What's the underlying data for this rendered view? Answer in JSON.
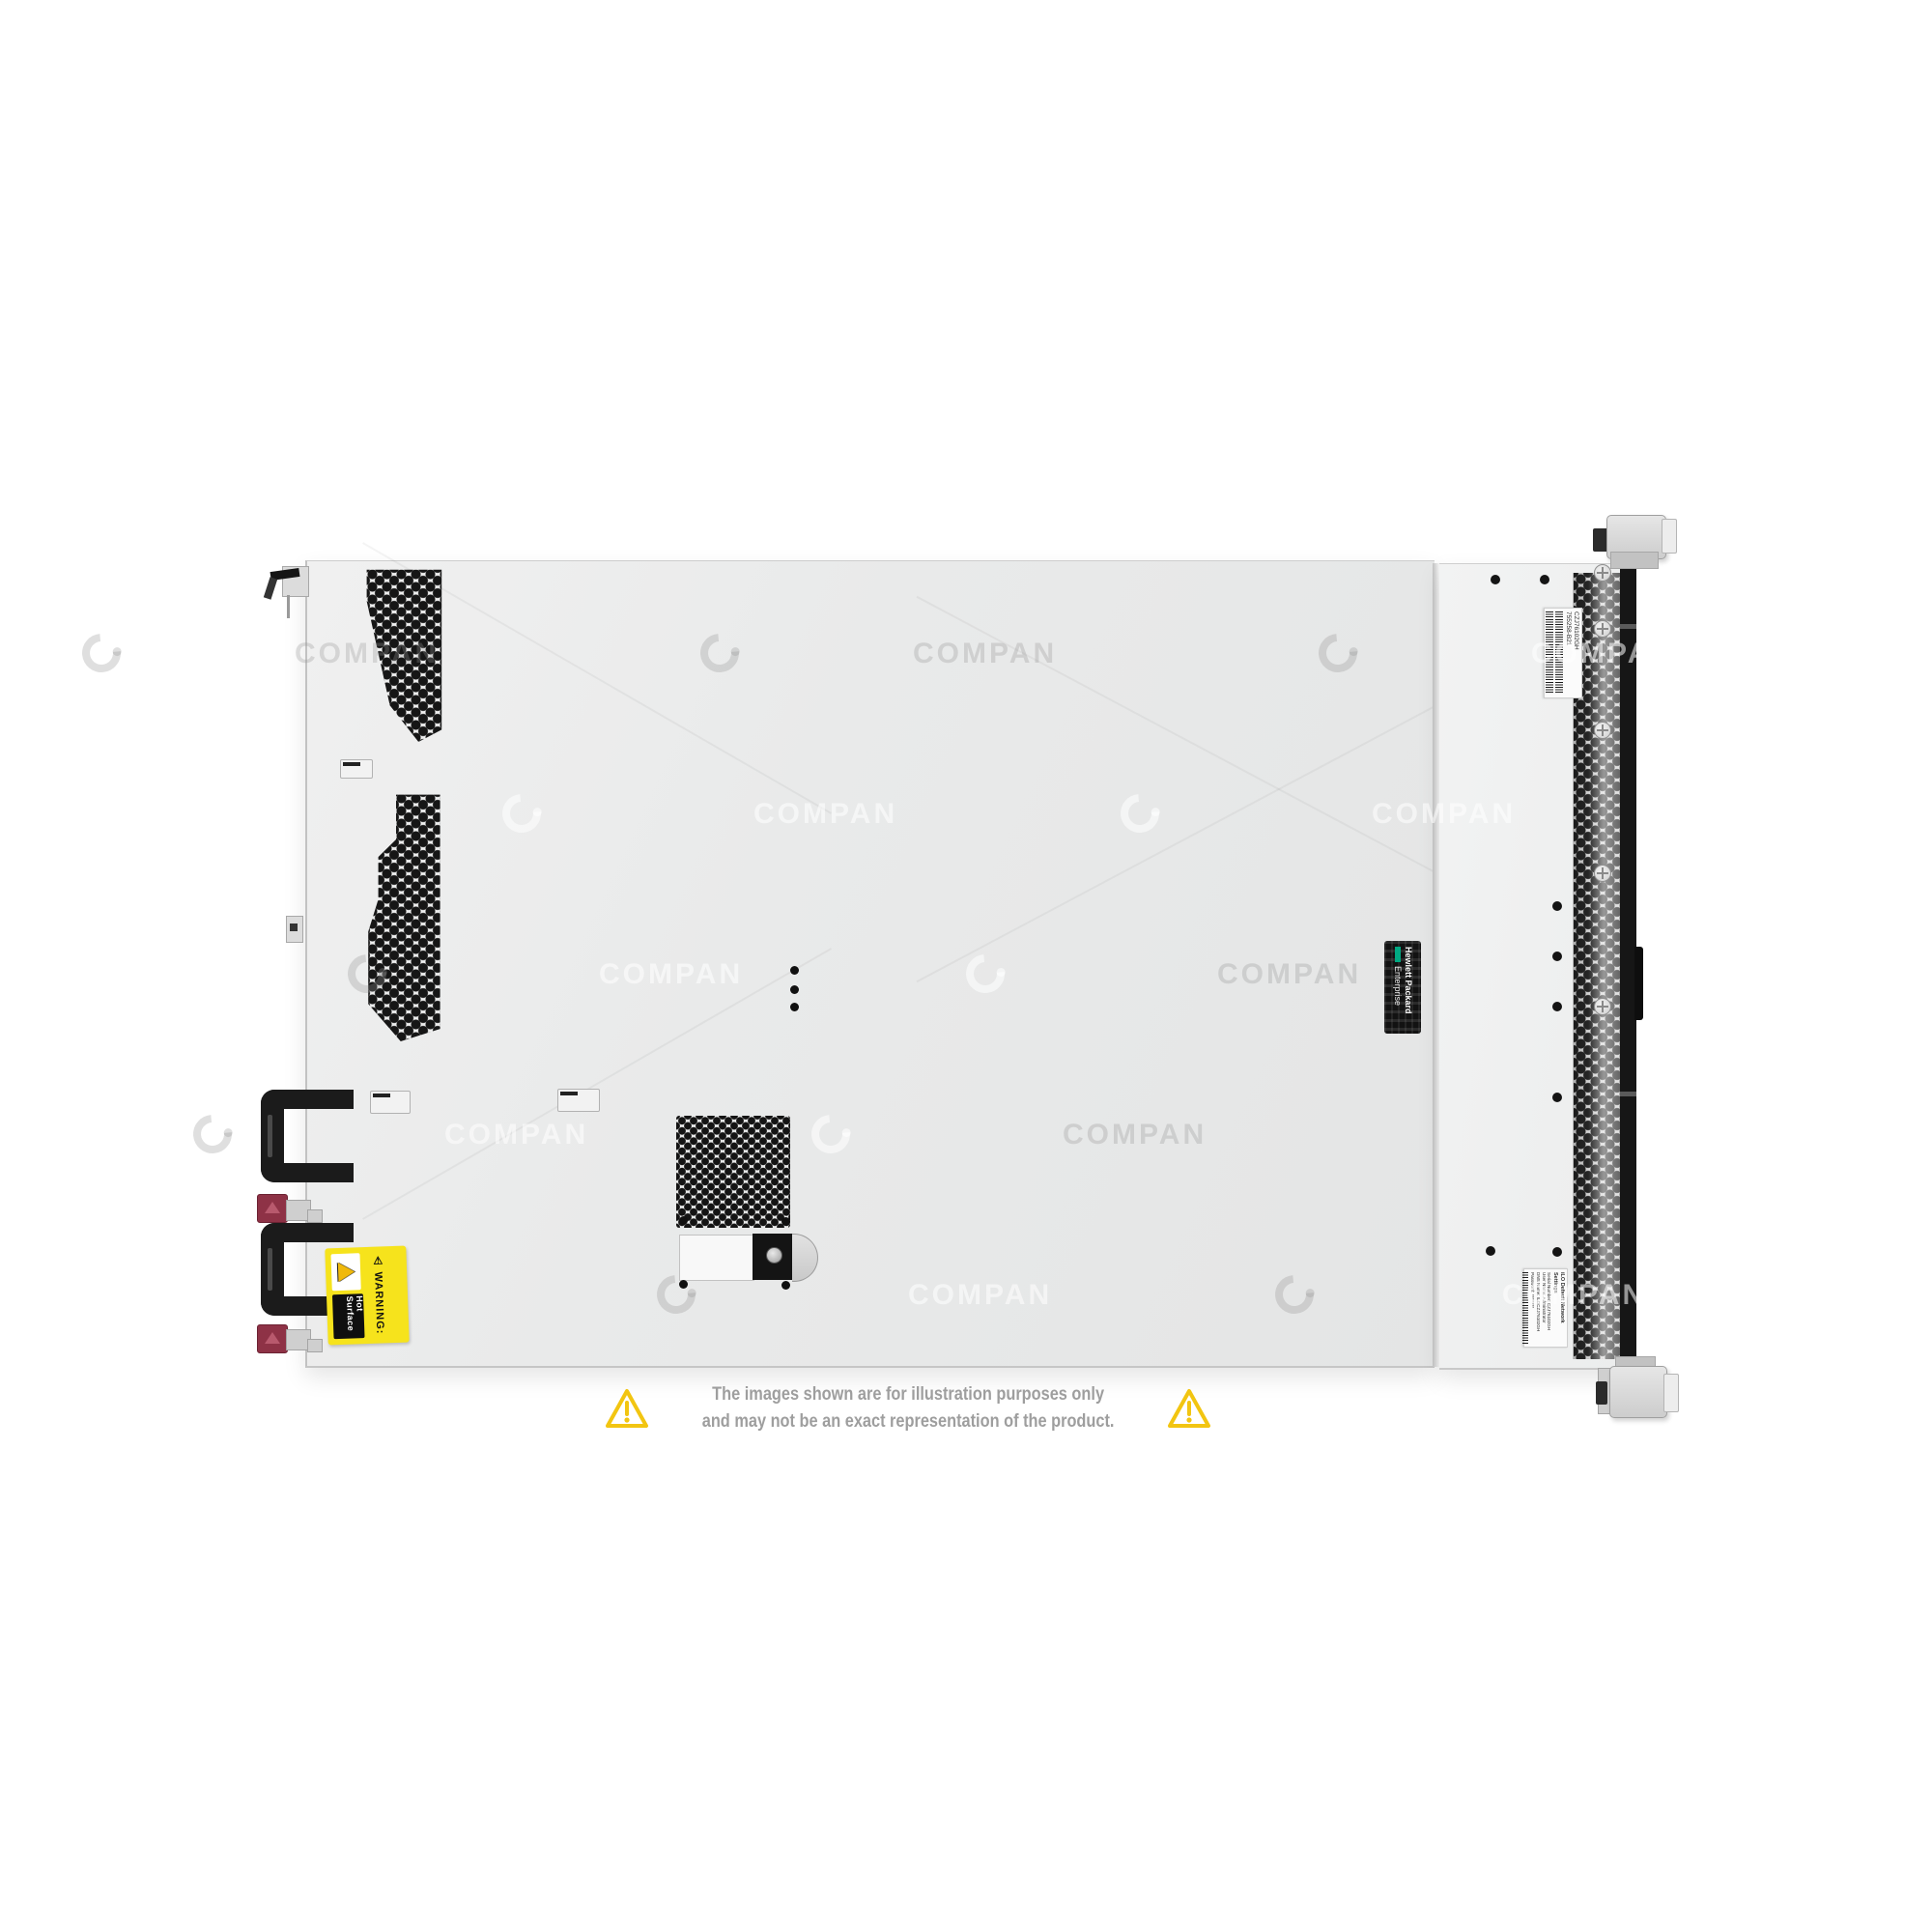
{
  "watermark": {
    "text": "COMPAN"
  },
  "disclaimer": {
    "line1": "The images shown are for illustration purposes only",
    "line2": "and may not be an exact representation of the product."
  },
  "warning_label": {
    "glyph": "⚠",
    "heading": "WARNING:",
    "text": "Hot Surface"
  },
  "hpe_label": {
    "line1": "Hewlett Packard",
    "line2": "Enterprise"
  },
  "serial_label": {
    "serial": "CZJ76102GH",
    "part": "755258-B21"
  },
  "ilo_label": {
    "title": "iLO Default Network Settings",
    "line1": "Serial Number: CZJ76102GH",
    "line2": "User Name: Administrator",
    "line3": "DNS Name: ILOCZJ76102GH",
    "line4": "Password: ********"
  },
  "colors": {
    "background": "#ffffff",
    "chassis_cover": "#e9eaea",
    "front_panel": "#f1f2f2",
    "vent_hole": "#161616",
    "front_black_strip": "#161616",
    "psu_handle": "#1b1b1b",
    "release_tab_red": "#8e3246",
    "warning_yellow": "#f6e31c",
    "hpe_green": "#01a982",
    "disclaimer_text": "#9e9e9e",
    "disclaimer_triangle": "#f2c511"
  }
}
